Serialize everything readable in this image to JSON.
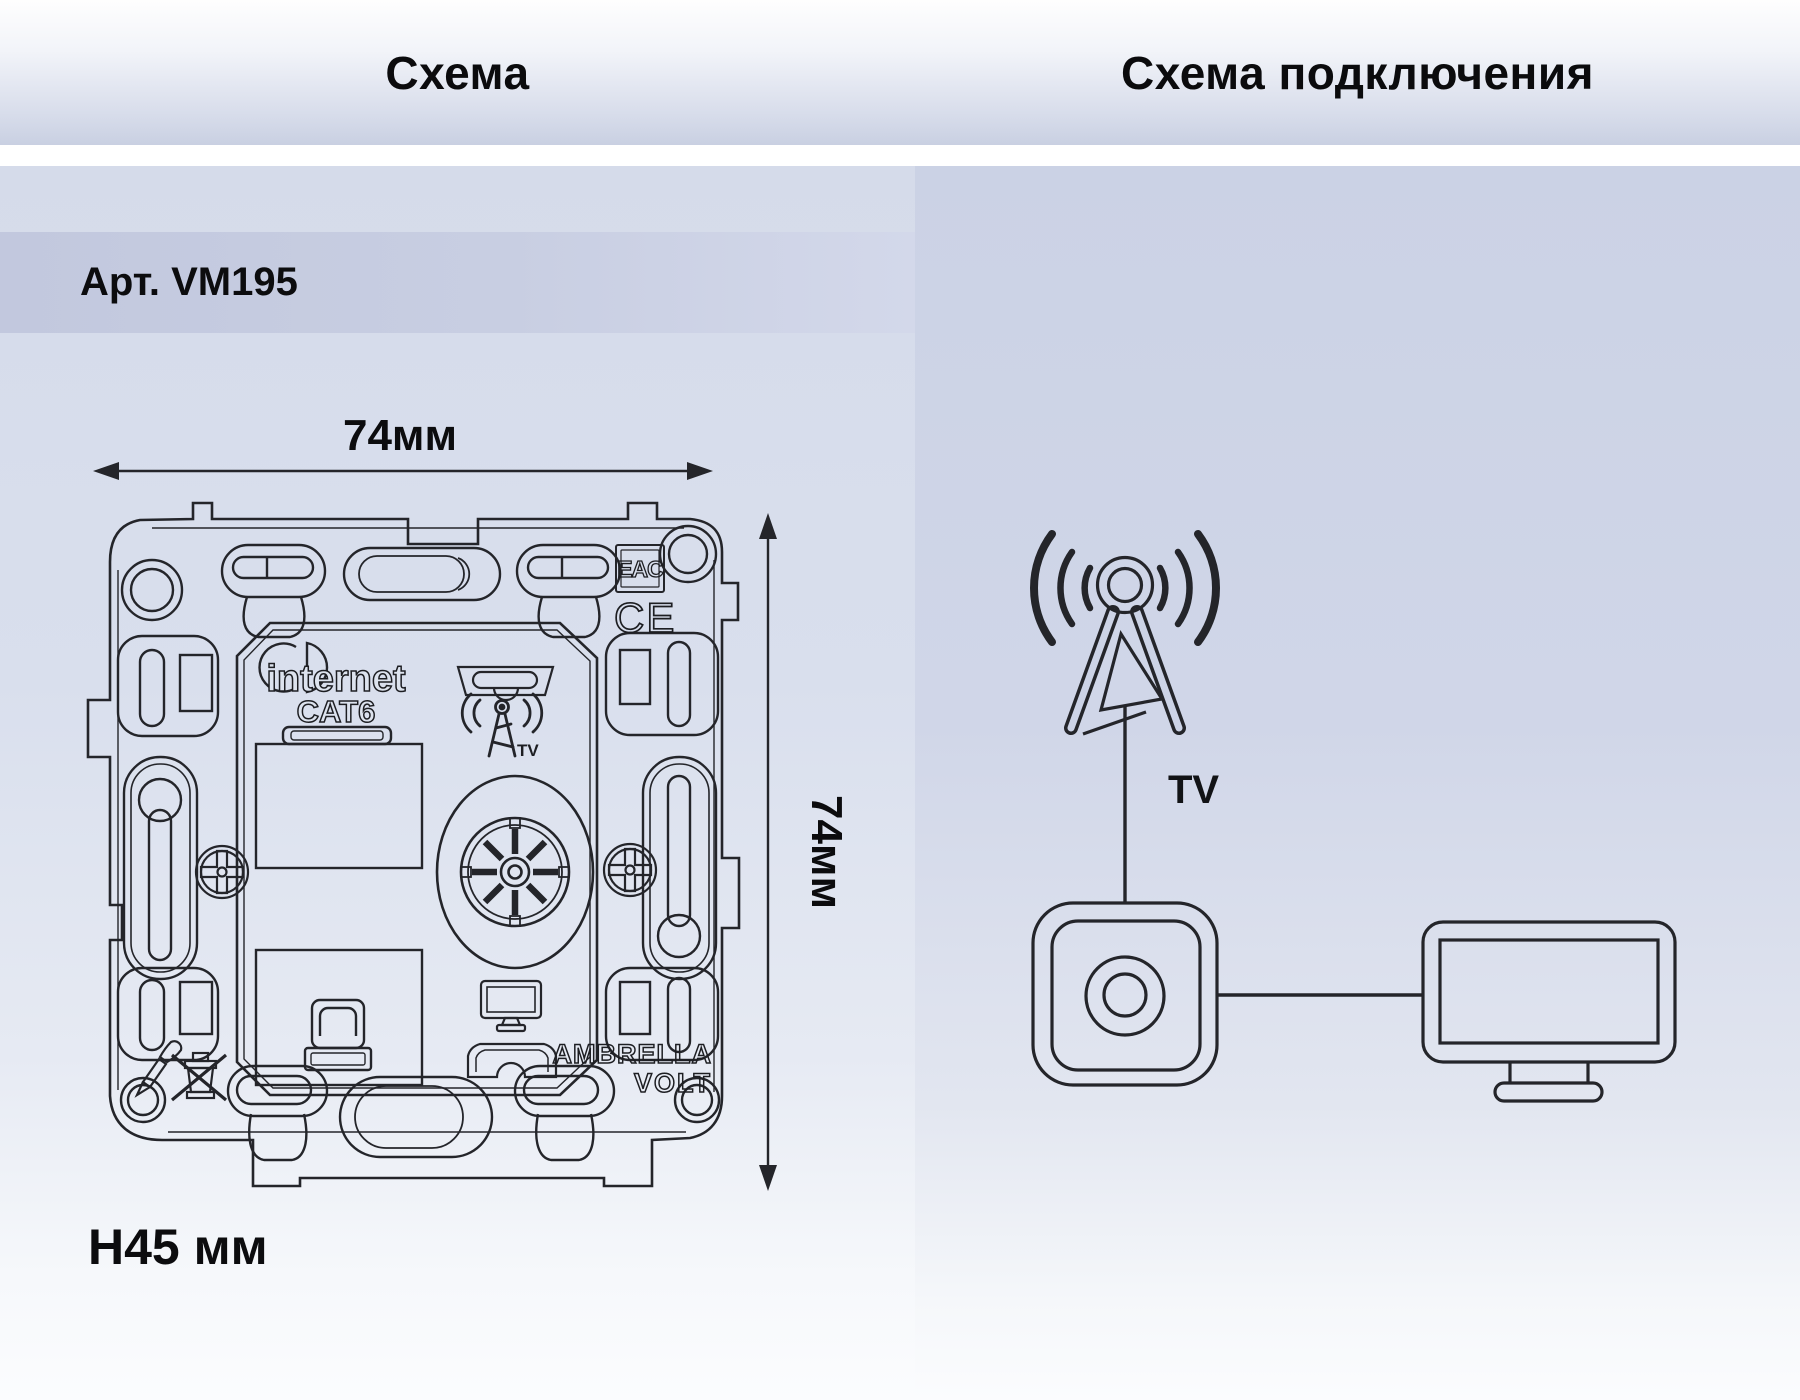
{
  "header": {
    "left": "Схема",
    "right": "Схема подключения"
  },
  "product": {
    "article": "Арт. VM195",
    "mount_depth": "H45 мм"
  },
  "left_diagram": {
    "dim_width": "74мм",
    "dim_height": "74мм",
    "port_label_line1": "internet",
    "port_label_line2": "CAT6",
    "tv_port_label": "TV",
    "cert_eac": "EAC",
    "cert_ce": "CE",
    "brand_line1": "AMBRELLA",
    "brand_line2": "VOLT"
  },
  "right_diagram": {
    "cable_label": "TV"
  },
  "icons": {
    "antenna-tower-icon": "broadcast tower with radio waves",
    "wall-socket-icon": "rounded wall plate with coax connector",
    "tv-monitor-icon": "television on stand",
    "coax-tv-connector": "spoked coaxial TV socket",
    "rj45-jack": "ethernet keystone jack",
    "screwdriver-icon": "installation tool mark",
    "do-not-dispose-icon": "crossed-out bin mark",
    "eac-mark": "EAC conformity mark",
    "ce-mark": "CE conformity mark"
  },
  "colors": {
    "ink": "#24252a",
    "band": "#c5cbe0",
    "panel_left": "#d7ddeb",
    "panel_right": "#ced4e7"
  }
}
